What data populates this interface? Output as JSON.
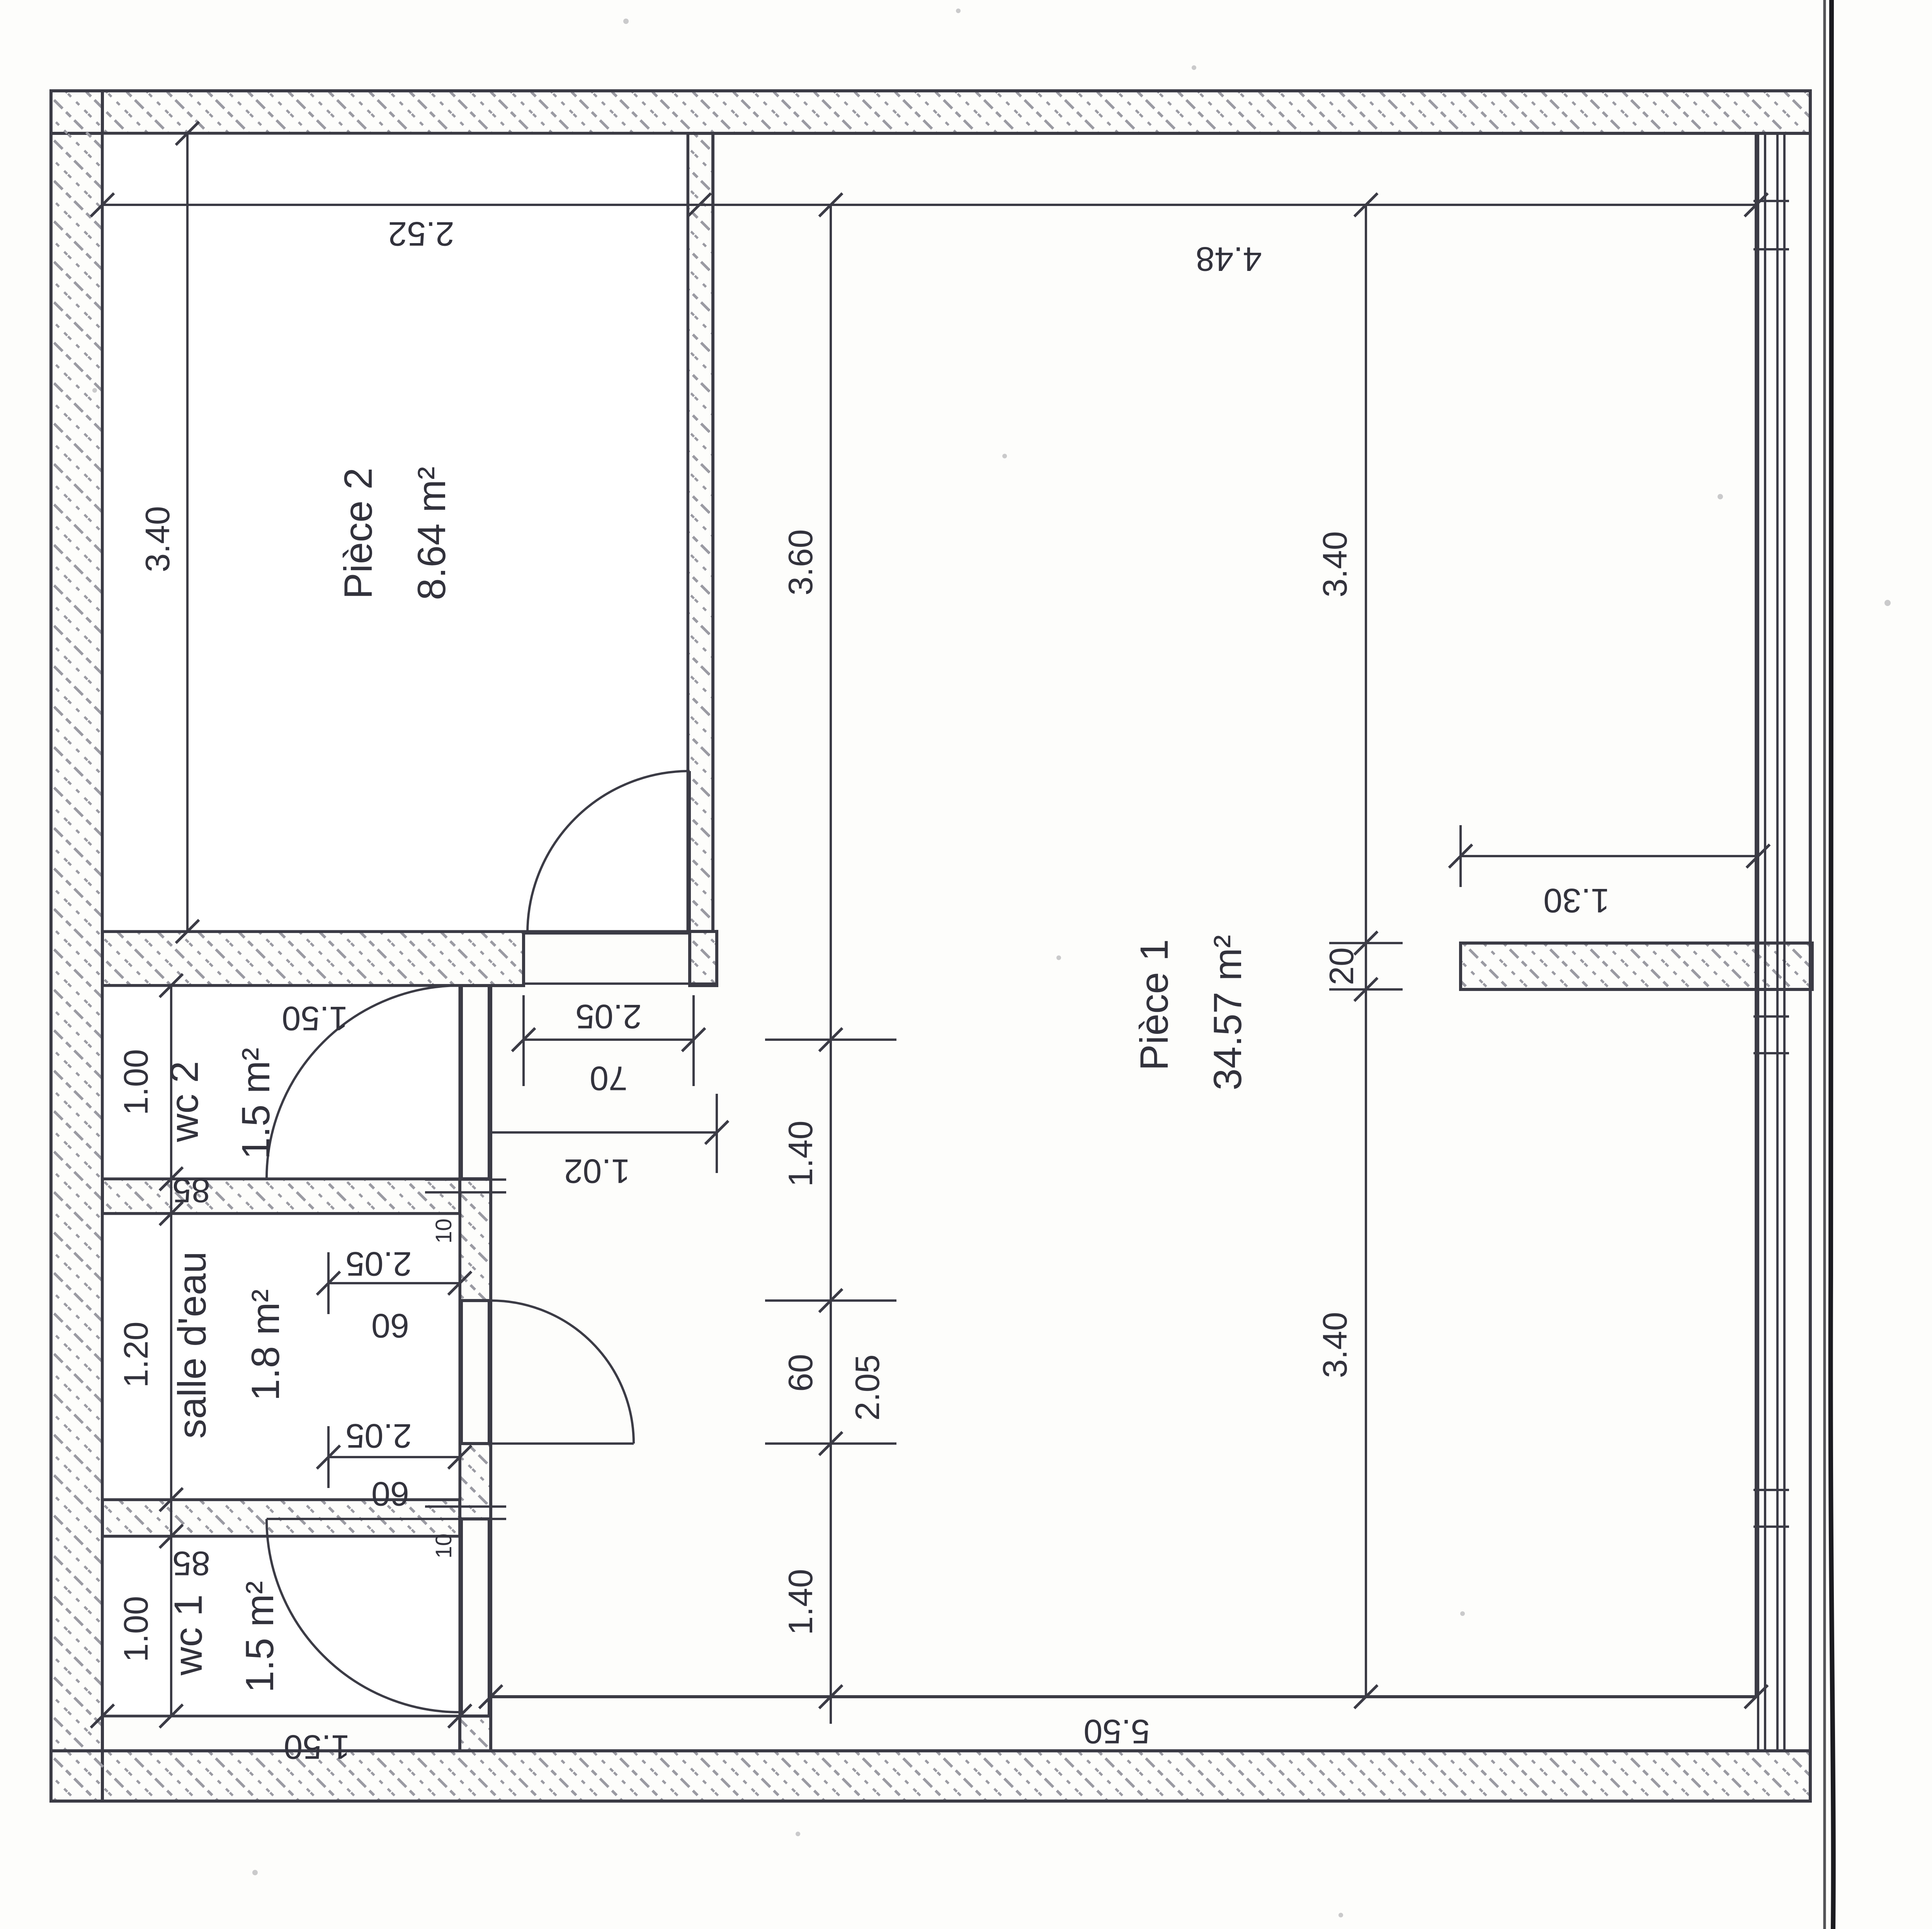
{
  "document": {
    "type": "scanned floor plan (rotated)",
    "language": "fr"
  },
  "colors": {
    "ink": "#32323c",
    "line": "#3b3b45",
    "hatch": "#9a9aa2",
    "scan_edge": "#1b1b20",
    "paper": "#fdfdfb"
  },
  "rooms": {
    "piece2": {
      "name": "Pièce 2",
      "area": "8.64 m²"
    },
    "piece1": {
      "name": "Pièce 1",
      "area": "34.57 m²"
    },
    "wc2": {
      "name": "wc 2",
      "area": "1.5 m²"
    },
    "salle_deau": {
      "name": "salle d'eau",
      "area": "1.8 m²"
    },
    "wc1": {
      "name": "wc 1",
      "area": "1.5 m²"
    }
  },
  "dims": {
    "piece2_width": "2.52",
    "piece1_width": "4.48",
    "piece2_height": "3.40",
    "center_top": "3.60",
    "center_mid": "1.40",
    "center_door_width": "60",
    "center_door_height": "2.05",
    "center_bottom": "1.40",
    "right_top": "3.40",
    "wall_stub_thickness": "20",
    "right_bottom": "3.40",
    "wall_stub_length": "1.30",
    "piece2_door_height": "2.05",
    "piece2_door_width": "70",
    "hall_width": "1.02",
    "wc2_width": "1.50",
    "wc2_depth": "1.00",
    "wc2_door": "85",
    "wc2_wall": "10",
    "se_depth": "1.20",
    "se_door1_height": "2.05",
    "se_door1_width": "60",
    "se_door2_height": "2.05",
    "se_door2_width": "60",
    "wc1_depth": "1.00",
    "wc1_door": "85",
    "wc1_wall": "10",
    "wc1_width": "1.50",
    "piece1_bottom_width": "5.50"
  }
}
